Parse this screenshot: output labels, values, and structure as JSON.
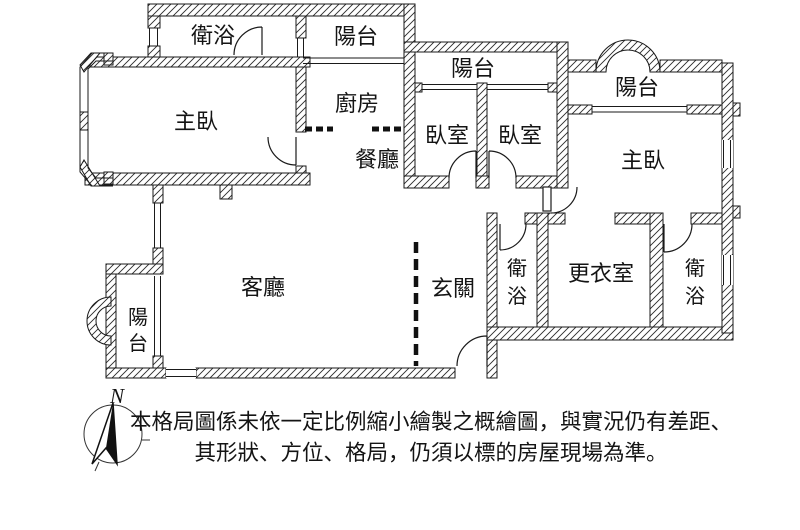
{
  "floorplan": {
    "rooms": {
      "bath_nw": {
        "label": "衛浴"
      },
      "balcony_n1": {
        "label": "陽台"
      },
      "master_w": {
        "label": "主臥"
      },
      "kitchen": {
        "label": "廚房"
      },
      "dining": {
        "label": "餐廳"
      },
      "balcony_n2": {
        "label": "陽台"
      },
      "bedroom_1": {
        "label": "臥室"
      },
      "bedroom_2": {
        "label": "臥室"
      },
      "balcony_ne": {
        "label": "陽台"
      },
      "master_e": {
        "label": "主臥"
      },
      "living": {
        "label": "客廳"
      },
      "entry": {
        "label": "玄關"
      },
      "bath_mid": {
        "char1": "衛",
        "char2": "浴"
      },
      "closet": {
        "label": "更衣室"
      },
      "bath_e": {
        "char1": "衛",
        "char2": "浴"
      },
      "balcony_sw": {
        "char1": "陽",
        "char2": "台"
      }
    },
    "compass": {
      "north_label": "N"
    },
    "disclaimer": {
      "line1": "本格局圖係未依一定比例縮小繪製之概繪圖，與實況仍有差距、",
      "line2": "其形狀、方位、格局，仍須以標的房屋現場為準。"
    },
    "colors": {
      "ink": "#1a1a1a",
      "background": "#ffffff"
    }
  }
}
